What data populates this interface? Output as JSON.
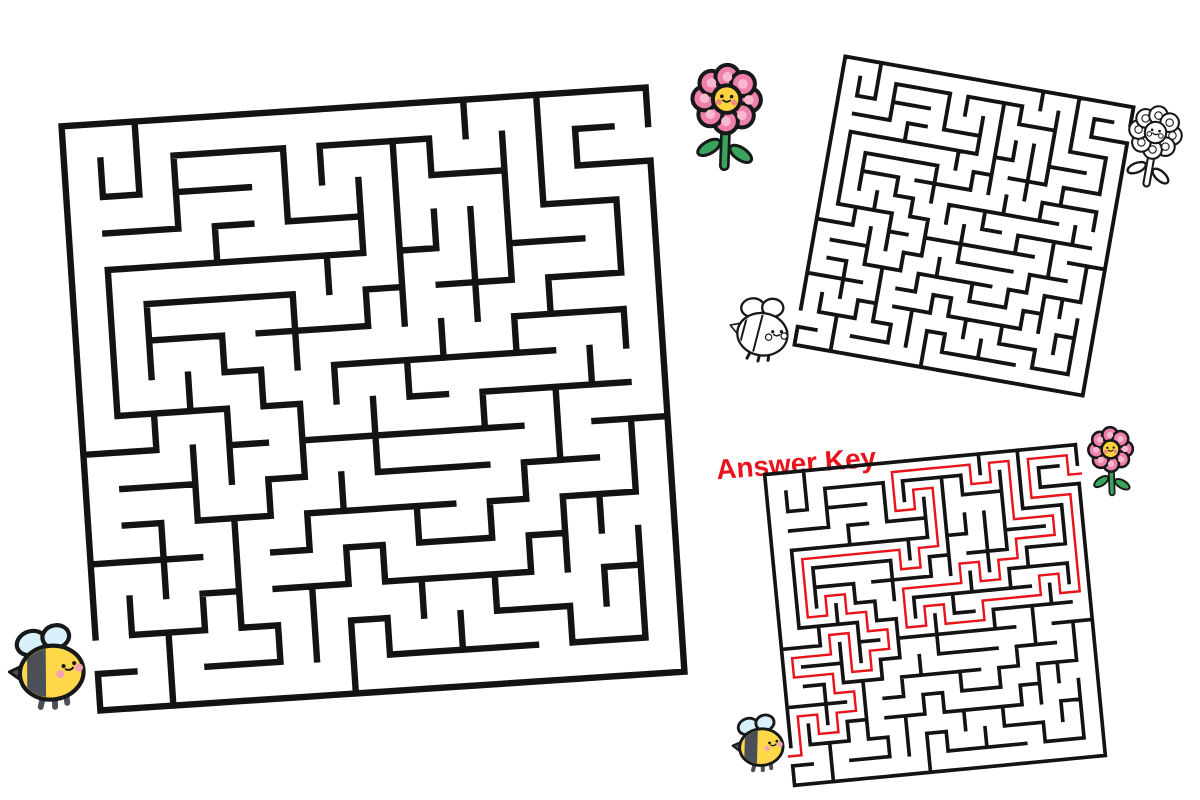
{
  "page": {
    "background": "#ffffff"
  },
  "colors": {
    "page_bg": "#ffffff",
    "wall": "#131313",
    "answer_red": "#e9141b"
  },
  "answer_key": {
    "label": "Answer Key"
  },
  "maze": {
    "cols": 16,
    "rows": 16,
    "seed": 8,
    "entry": {
      "side": "left",
      "row": 14,
      "marker": "bee"
    },
    "exit": {
      "side": "right",
      "row": 1,
      "marker": "flower"
    },
    "instances": [
      {
        "id": "maze-large",
        "variant": "puzzle"
      },
      {
        "id": "maze-blank",
        "variant": "worksheet-thumbnail"
      },
      {
        "id": "maze-answer",
        "variant": "answer-key",
        "shows_solution": true
      }
    ]
  },
  "icons": {
    "bee": {
      "body": "#ffd84a",
      "stripe": "#4b5058",
      "wing": "#d8f0fa",
      "cheek": "#f5a3b4",
      "outline": "#17181a"
    },
    "flower": {
      "petal": "#ef7fab",
      "petal_inner": "#f8b9ce",
      "center": "#ffd23f",
      "cheek": "#ee8d7f",
      "stem": "#3aa45c",
      "outline": "#17181a"
    }
  }
}
